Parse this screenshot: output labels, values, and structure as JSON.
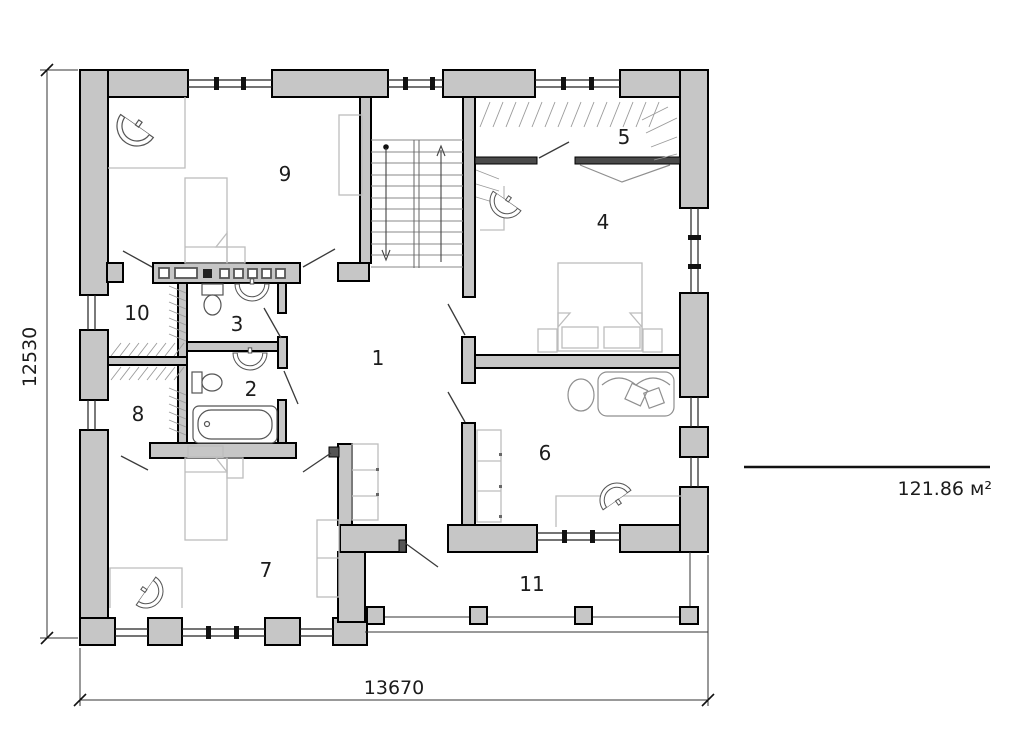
{
  "plan": {
    "rooms": [
      {
        "number": "1"
      },
      {
        "number": "2"
      },
      {
        "number": "3"
      },
      {
        "number": "4"
      },
      {
        "number": "5"
      },
      {
        "number": "6"
      },
      {
        "number": "7"
      },
      {
        "number": "8"
      },
      {
        "number": "9"
      },
      {
        "number": "10"
      },
      {
        "number": "11"
      }
    ],
    "dimensions": {
      "vertical": "12530",
      "horizontal": "13670"
    },
    "area_label": "121.86 м²",
    "colors": {
      "wall_fill": "#c6c6c6",
      "line": "#1a1a1a",
      "furniture_line": "#9b9b9b"
    }
  }
}
